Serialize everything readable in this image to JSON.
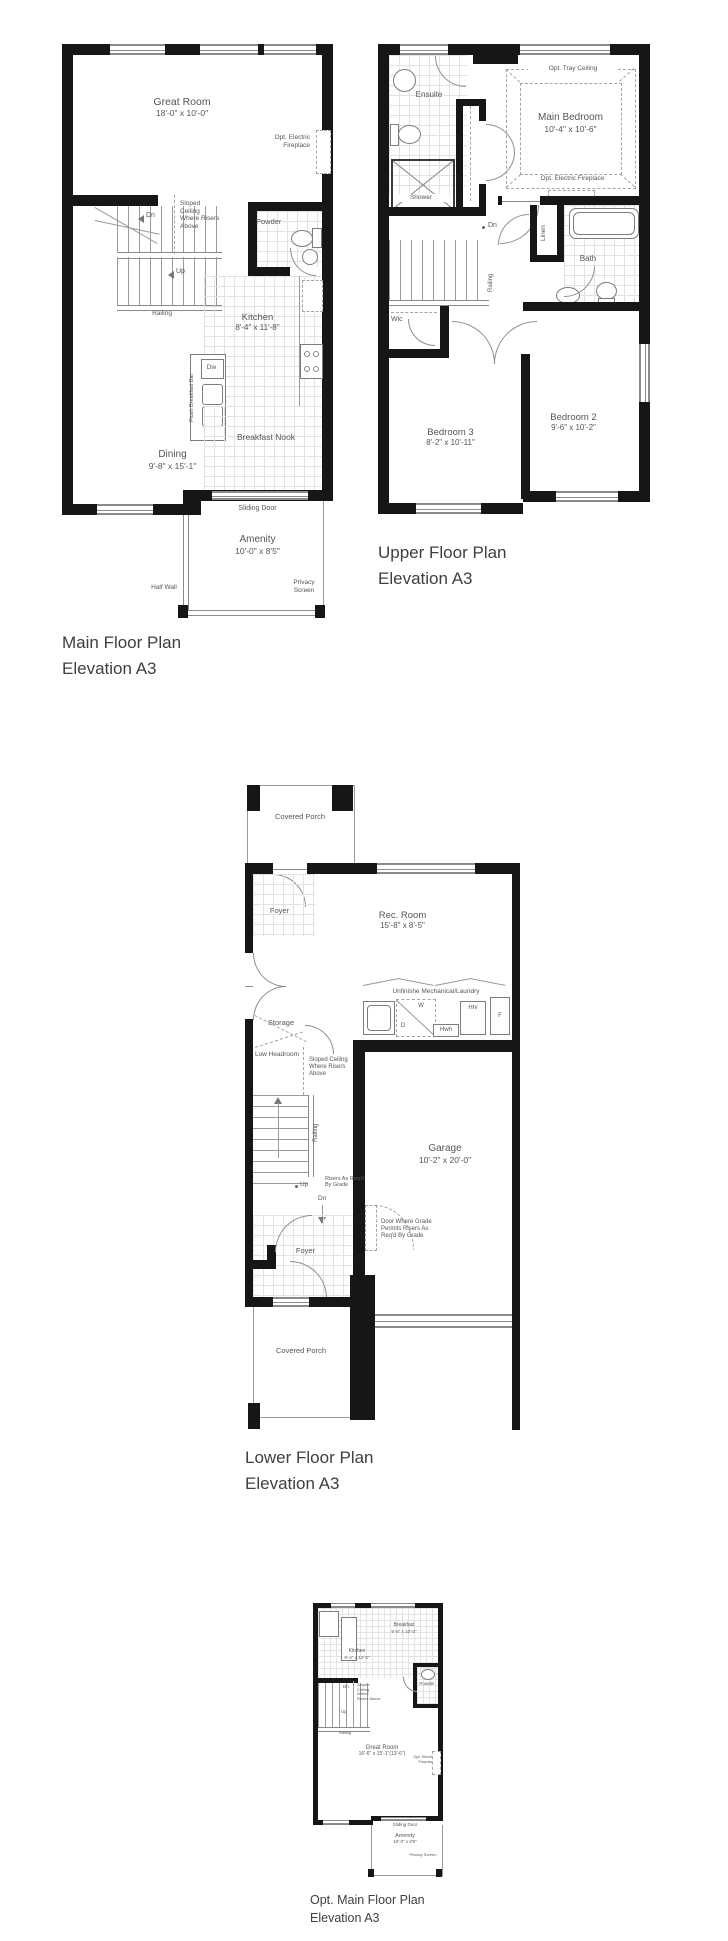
{
  "sheet": {
    "background": "#ffffff",
    "wall_color": "#161616",
    "line_color": "#9a9a9a",
    "text_color": "#55565a"
  },
  "plans": {
    "main": {
      "title": [
        "Main Floor Plan",
        "Elevation A3"
      ],
      "rooms": {
        "great_room": {
          "name": "Great Room",
          "dim": "18'-0\" x 10'-0\""
        },
        "powder": {
          "name": "Powder"
        },
        "kitchen": {
          "name": "Kitchen",
          "dim": "8'-4\" x 11'-8\""
        },
        "dining": {
          "name": "Dining",
          "dim": "9'-8\" x 15'-1\""
        },
        "breakfast_nook": {
          "name": "Breakfast Nook"
        },
        "amenity": {
          "name": "Amenity",
          "dim": "10'-0\" x 8'5\""
        }
      },
      "notes": {
        "opt_fireplace": "Opt. Electric Fireplace",
        "sloped_ceiling": "Sloped Ceiling Where Risers Above",
        "dn": "Dn",
        "up": "Up",
        "railing": "Railing",
        "flush_bar": "Flush Breakfast Bar",
        "dw": "Dw",
        "sliding_door": "Sliding Door",
        "half_wall": "Half Wall",
        "privacy_screen": "Privacy Screen"
      }
    },
    "upper": {
      "title": [
        "Upper Floor Plan",
        "Elevation A3"
      ],
      "rooms": {
        "ensuite": {
          "name": "Ensuite"
        },
        "main_bedroom": {
          "name": "Main Bedroom",
          "dim": "10'-4\" x 10'-6\""
        },
        "bath": {
          "name": "Bath"
        },
        "bedroom2": {
          "name": "Bedroom 2",
          "dim": "9'-6\" x 10'-2\""
        },
        "bedroom3": {
          "name": "Bedroom 3",
          "dim": "8'-2\" x 10'-11\""
        },
        "wic": {
          "name": "Wic"
        },
        "linen": {
          "name": "Linen"
        }
      },
      "notes": {
        "shower": "Shower",
        "tray_ceiling": "Opt. Tray Ceiling",
        "opt_fireplace": "Opt. Electric Fireplace",
        "dn": "Dn",
        "railing": "Railing"
      }
    },
    "lower": {
      "title": [
        "Lower Floor Plan",
        "Elevation A3"
      ],
      "rooms": {
        "covered_porch": {
          "name": "Covered Porch"
        },
        "foyer": {
          "name": "Foyer"
        },
        "rec_room": {
          "name": "Rec. Room",
          "dim": "15'-8\" x 8'-5\""
        },
        "mech": {
          "name": "Unfinishe Mechanical/Laundry"
        },
        "storage": {
          "name": "Storage"
        },
        "garage": {
          "name": "Garage",
          "dim": "10'-2\" x 20'-0\""
        }
      },
      "notes": {
        "low_headroom": "Low Headroom",
        "sloped_ceiling": "Sloped Ceiling Where Risers Above",
        "railing": "Railing",
        "up": "Up",
        "dn": "Dn",
        "risers": "Risers As Req'd By Grade",
        "door_grade": "Door Where Grade Permits Risers As Req'd By Grade",
        "w": "W",
        "d": "D",
        "hwh": "Hwh",
        "hrv": "Hrv",
        "f": "F"
      }
    },
    "opt": {
      "title": [
        "Opt. Main Floor Plan",
        "Elevation A3"
      ],
      "rooms": {
        "breakfast": {
          "name": "Breakfast",
          "dim": "9'-6\" x 10'-0\""
        },
        "kitchen": {
          "name": "Kitchen",
          "dim": "9'-4\" x 12'-0\""
        },
        "powder": {
          "name": "Powder"
        },
        "great_room": {
          "name": "Great Room",
          "dim": "16'-6\" x 15'-1\"(13'-6\")"
        },
        "amenity": {
          "name": "Amenity",
          "dim": "10'-0\" x 8'5\""
        }
      },
      "notes": {
        "opt_fireplace": "Opt. Electric Fireplace",
        "sliding_door": "Sliding Door",
        "privacy_screen": "Privacy Screen",
        "dn": "Dn",
        "up": "Up",
        "railing": "Railing",
        "sloped_ceiling": "Sloped Ceiling Where Risers Above"
      }
    }
  }
}
